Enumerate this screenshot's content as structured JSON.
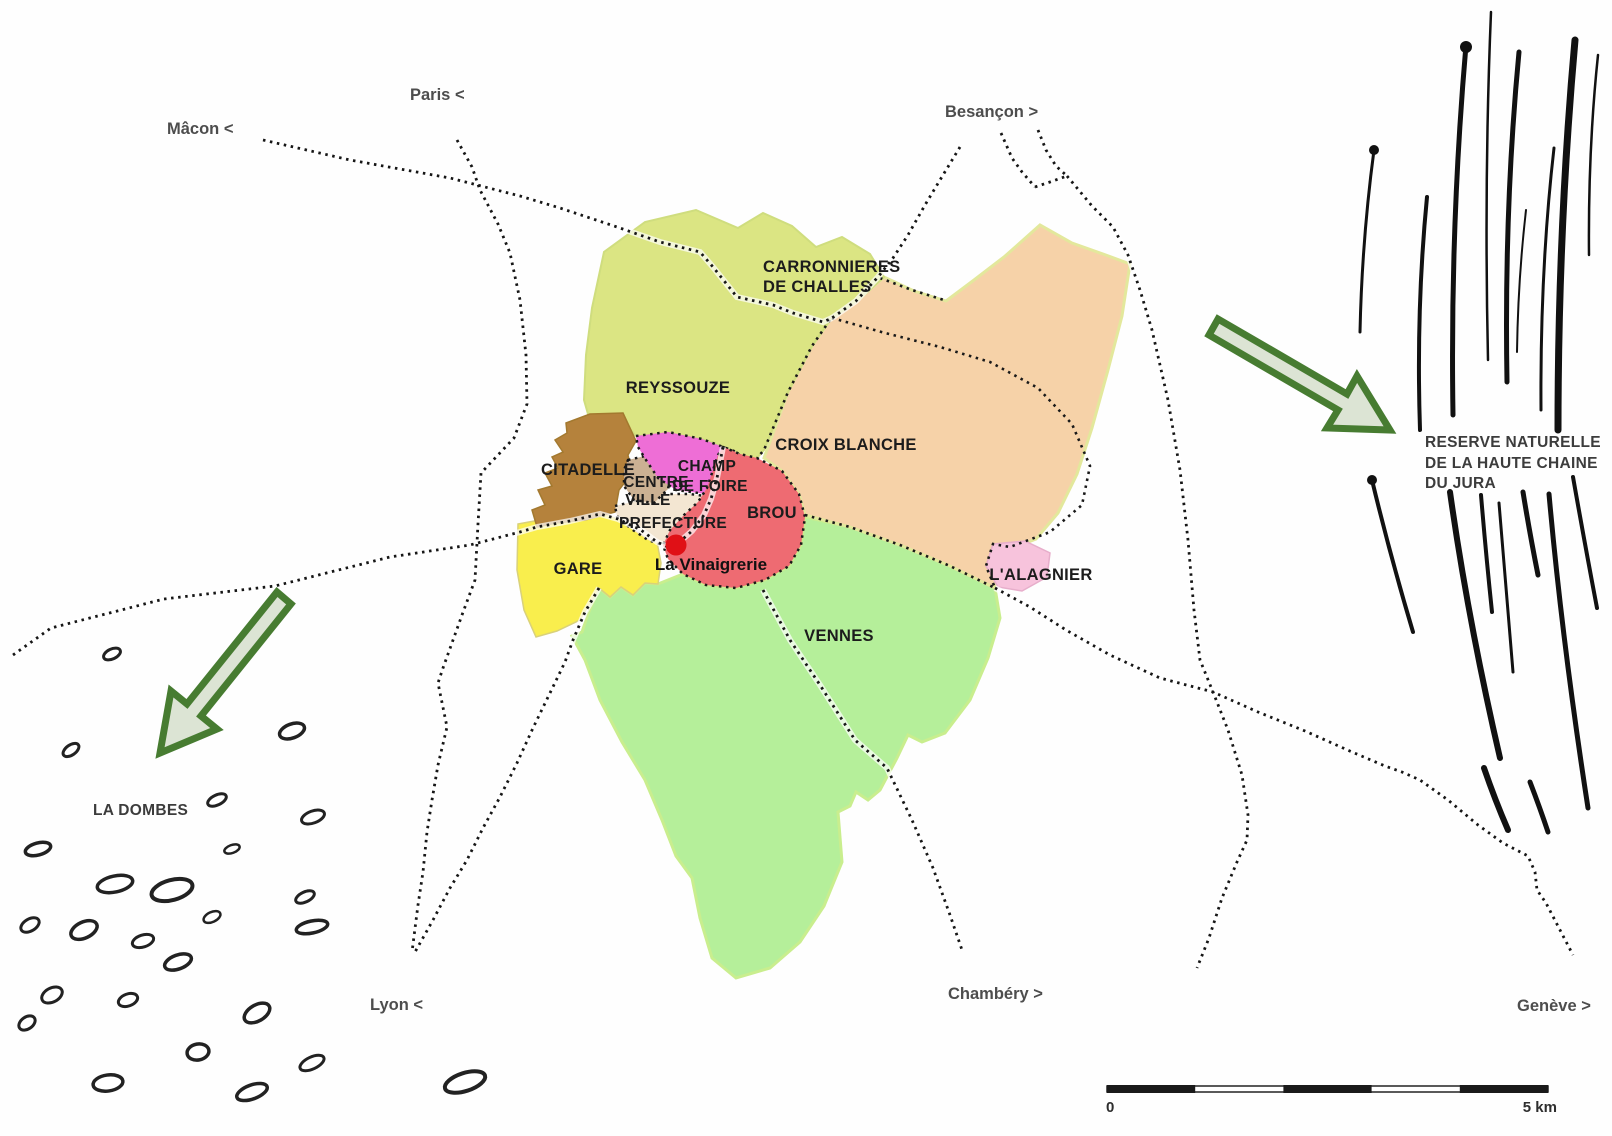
{
  "map": {
    "type": "city-district-plan",
    "scale_bar": {
      "start_label": "0",
      "end_label": "5 km"
    }
  },
  "districts": {
    "reyssouze": {
      "label": "REYSSOUZE",
      "color": "#dbe583"
    },
    "carronnieres": {
      "label_line1": "CARRONNIERES",
      "label_line2": "DE CHALLES",
      "color": "#dbe583"
    },
    "croix_blanche": {
      "label": "CROIX BLANCHE",
      "color": "#f6d2a8"
    },
    "citadelle": {
      "label": "CITADELLE",
      "color": "#b5823c"
    },
    "centre_ville": {
      "label_line1": "CENTRE",
      "label_line2": "VILLE",
      "color": "#cbb193"
    },
    "champ_de_foire": {
      "label_line1": "CHAMP",
      "label_line2": "DE FOIRE",
      "color": "#ee6ed6"
    },
    "prefecture": {
      "label": "PREFECTURE",
      "color": "#f3e6d2"
    },
    "brou": {
      "label": "BROU",
      "color": "#ee6b72"
    },
    "gare": {
      "label": "GARE",
      "color": "#f9ee4d"
    },
    "vennes": {
      "label": "VENNES",
      "color": "#b5ef9a"
    },
    "alagnier": {
      "label": "L'ALAGNIER",
      "color": "#f7c3dc"
    }
  },
  "poi": {
    "la_vinaigrerie": {
      "label": "La Vinaigrerie",
      "marker_color": "#e01016"
    }
  },
  "directions": {
    "macon": "Mâcon <",
    "paris": "Paris <",
    "besancon": "Besançon >",
    "lyon": "Lyon <",
    "chambery": "Chambéry >",
    "geneve": "Genève >"
  },
  "landmarks": {
    "la_dombes": {
      "label": "LA DOMBES"
    },
    "reserve_jura": {
      "line1": "RESERVE NATURELLE",
      "line2": "DE LA HAUTE CHAINE",
      "line3": "DU JURA"
    }
  },
  "arrow_style": {
    "stroke": "#477c31",
    "fill": "#dce4d4"
  }
}
